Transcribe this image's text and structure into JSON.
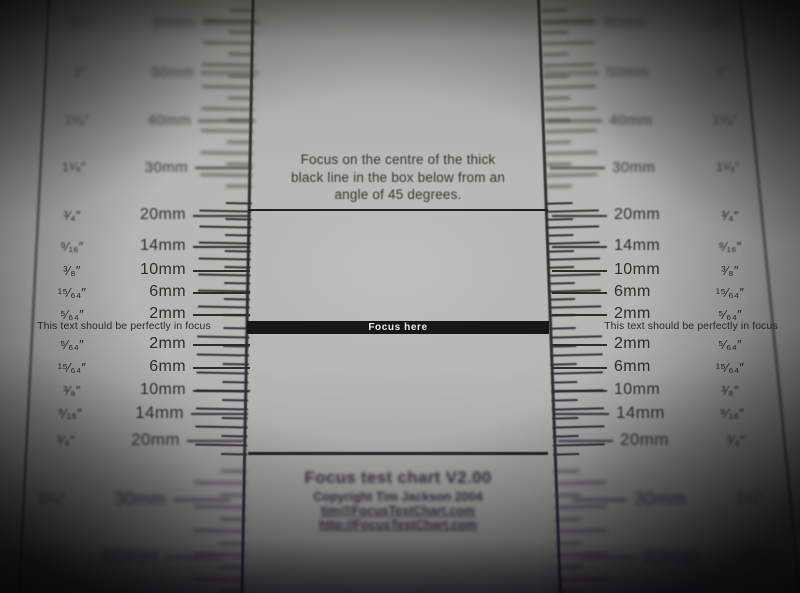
{
  "instruction_lines": [
    "Focus on the centre of the thick",
    "black line in the box below from an",
    "angle of 45 degrees."
  ],
  "focus_band_label": "Focus here",
  "focus_note": "This text should be perfectly in focus",
  "footer": {
    "title": "Focus test chart V2.00",
    "copyright": "Copyright Tim Jackson 2004",
    "email": "tim@FocusTestChart.com",
    "url": "http://FocusTestChart.com"
  },
  "ruler_rows_upper": [
    {
      "inch": "2³⁄₈″",
      "mm": "60mm"
    },
    {
      "inch": "2″",
      "mm": "50mm"
    },
    {
      "inch": "1⁵⁄₈″",
      "mm": "40mm"
    },
    {
      "inch": "1¹⁄₈″",
      "mm": "30mm"
    },
    {
      "inch": "³⁄₄″",
      "mm": "20mm"
    },
    {
      "inch": "⁹⁄₁₆″",
      "mm": "14mm"
    },
    {
      "inch": "³⁄₈″",
      "mm": "10mm"
    },
    {
      "inch": "¹⁵⁄₆₄″",
      "mm": "6mm"
    },
    {
      "inch": "⁵⁄₆₄″",
      "mm": "2mm"
    }
  ],
  "ruler_rows_lower": [
    {
      "inch": "⁵⁄₆₄″",
      "mm": "2mm"
    },
    {
      "inch": "¹⁵⁄₆₄″",
      "mm": "6mm"
    },
    {
      "inch": "³⁄₈″",
      "mm": "10mm"
    },
    {
      "inch": "⁹⁄₁₆″",
      "mm": "14mm"
    },
    {
      "inch": "³⁄₄″",
      "mm": "20mm"
    },
    {
      "inch": "1¹⁄₈″",
      "mm": "30mm"
    },
    {
      "inch": "1⁵⁄₈″",
      "mm": "40mm"
    }
  ],
  "colors": {
    "paper": "#b4b5b1",
    "ink": "#2d2e2a",
    "focus_band": "#171715",
    "band_text": "#ece9e4"
  }
}
